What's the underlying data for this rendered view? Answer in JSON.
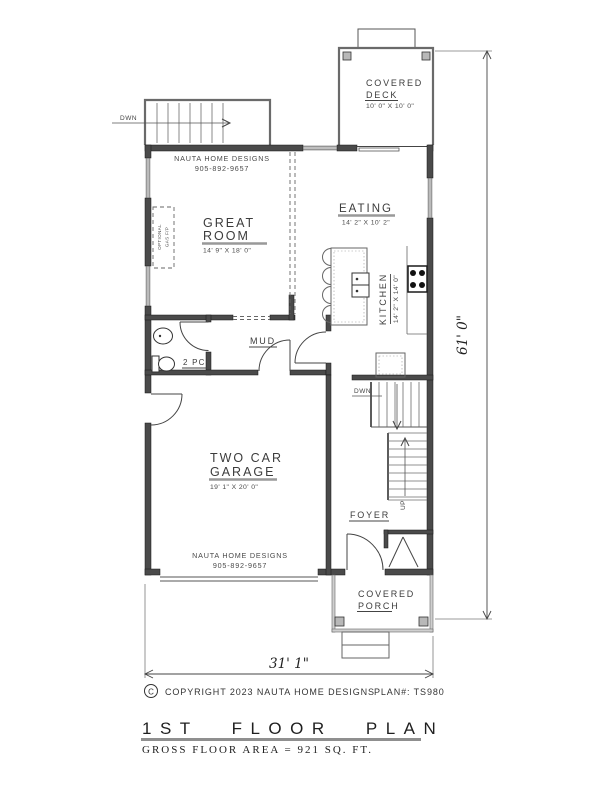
{
  "plan": {
    "deck": {
      "line1": "COVERED",
      "line2": "DECK",
      "dims": "10' 0\" X 10' 0\""
    },
    "great_room": {
      "line1": "GREAT",
      "line2": "ROOM",
      "dims": "14' 9\" X 18' 0\""
    },
    "eating": {
      "name": "EATING",
      "dims": "14' 2\" X 10' 2\""
    },
    "kitchen": {
      "name": "KITCHEN",
      "dims": "14' 2\" X 14' 0\""
    },
    "mud": {
      "name": "MUD"
    },
    "bath": {
      "name": "2 PC"
    },
    "garage": {
      "line1": "TWO CAR",
      "line2": "GARAGE",
      "dims": "19' 1\" X 20' 0\""
    },
    "foyer": {
      "name": "FOYER"
    },
    "porch": {
      "line1": "COVERED",
      "line2": "PORCH"
    },
    "fireplace": {
      "line1": "OPTIONAL",
      "line2": "GAS F/P"
    },
    "stairs": {
      "down_exterior": "DWN",
      "down_interior": "DWN",
      "up": "UP"
    },
    "branding": {
      "firm": "NAUTA HOME DESIGNS",
      "phone": "905-892-9657"
    },
    "dims": {
      "width": "31' 1\"",
      "depth": "61' 0\""
    },
    "footer": {
      "copyright_symbol": "C",
      "copyright": "COPYRIGHT 2023 NAUTA HOME DESIGNS",
      "plan_no": "PLAN#: TS980",
      "title": "1ST FLOOR PLAN",
      "subtitle": "GROSS FLOOR AREA = 921 SQ. FT."
    },
    "colors": {
      "wall": "#4a4a4a",
      "line": "#444444",
      "underline": "#999999",
      "paper": "#ffffff"
    }
  }
}
